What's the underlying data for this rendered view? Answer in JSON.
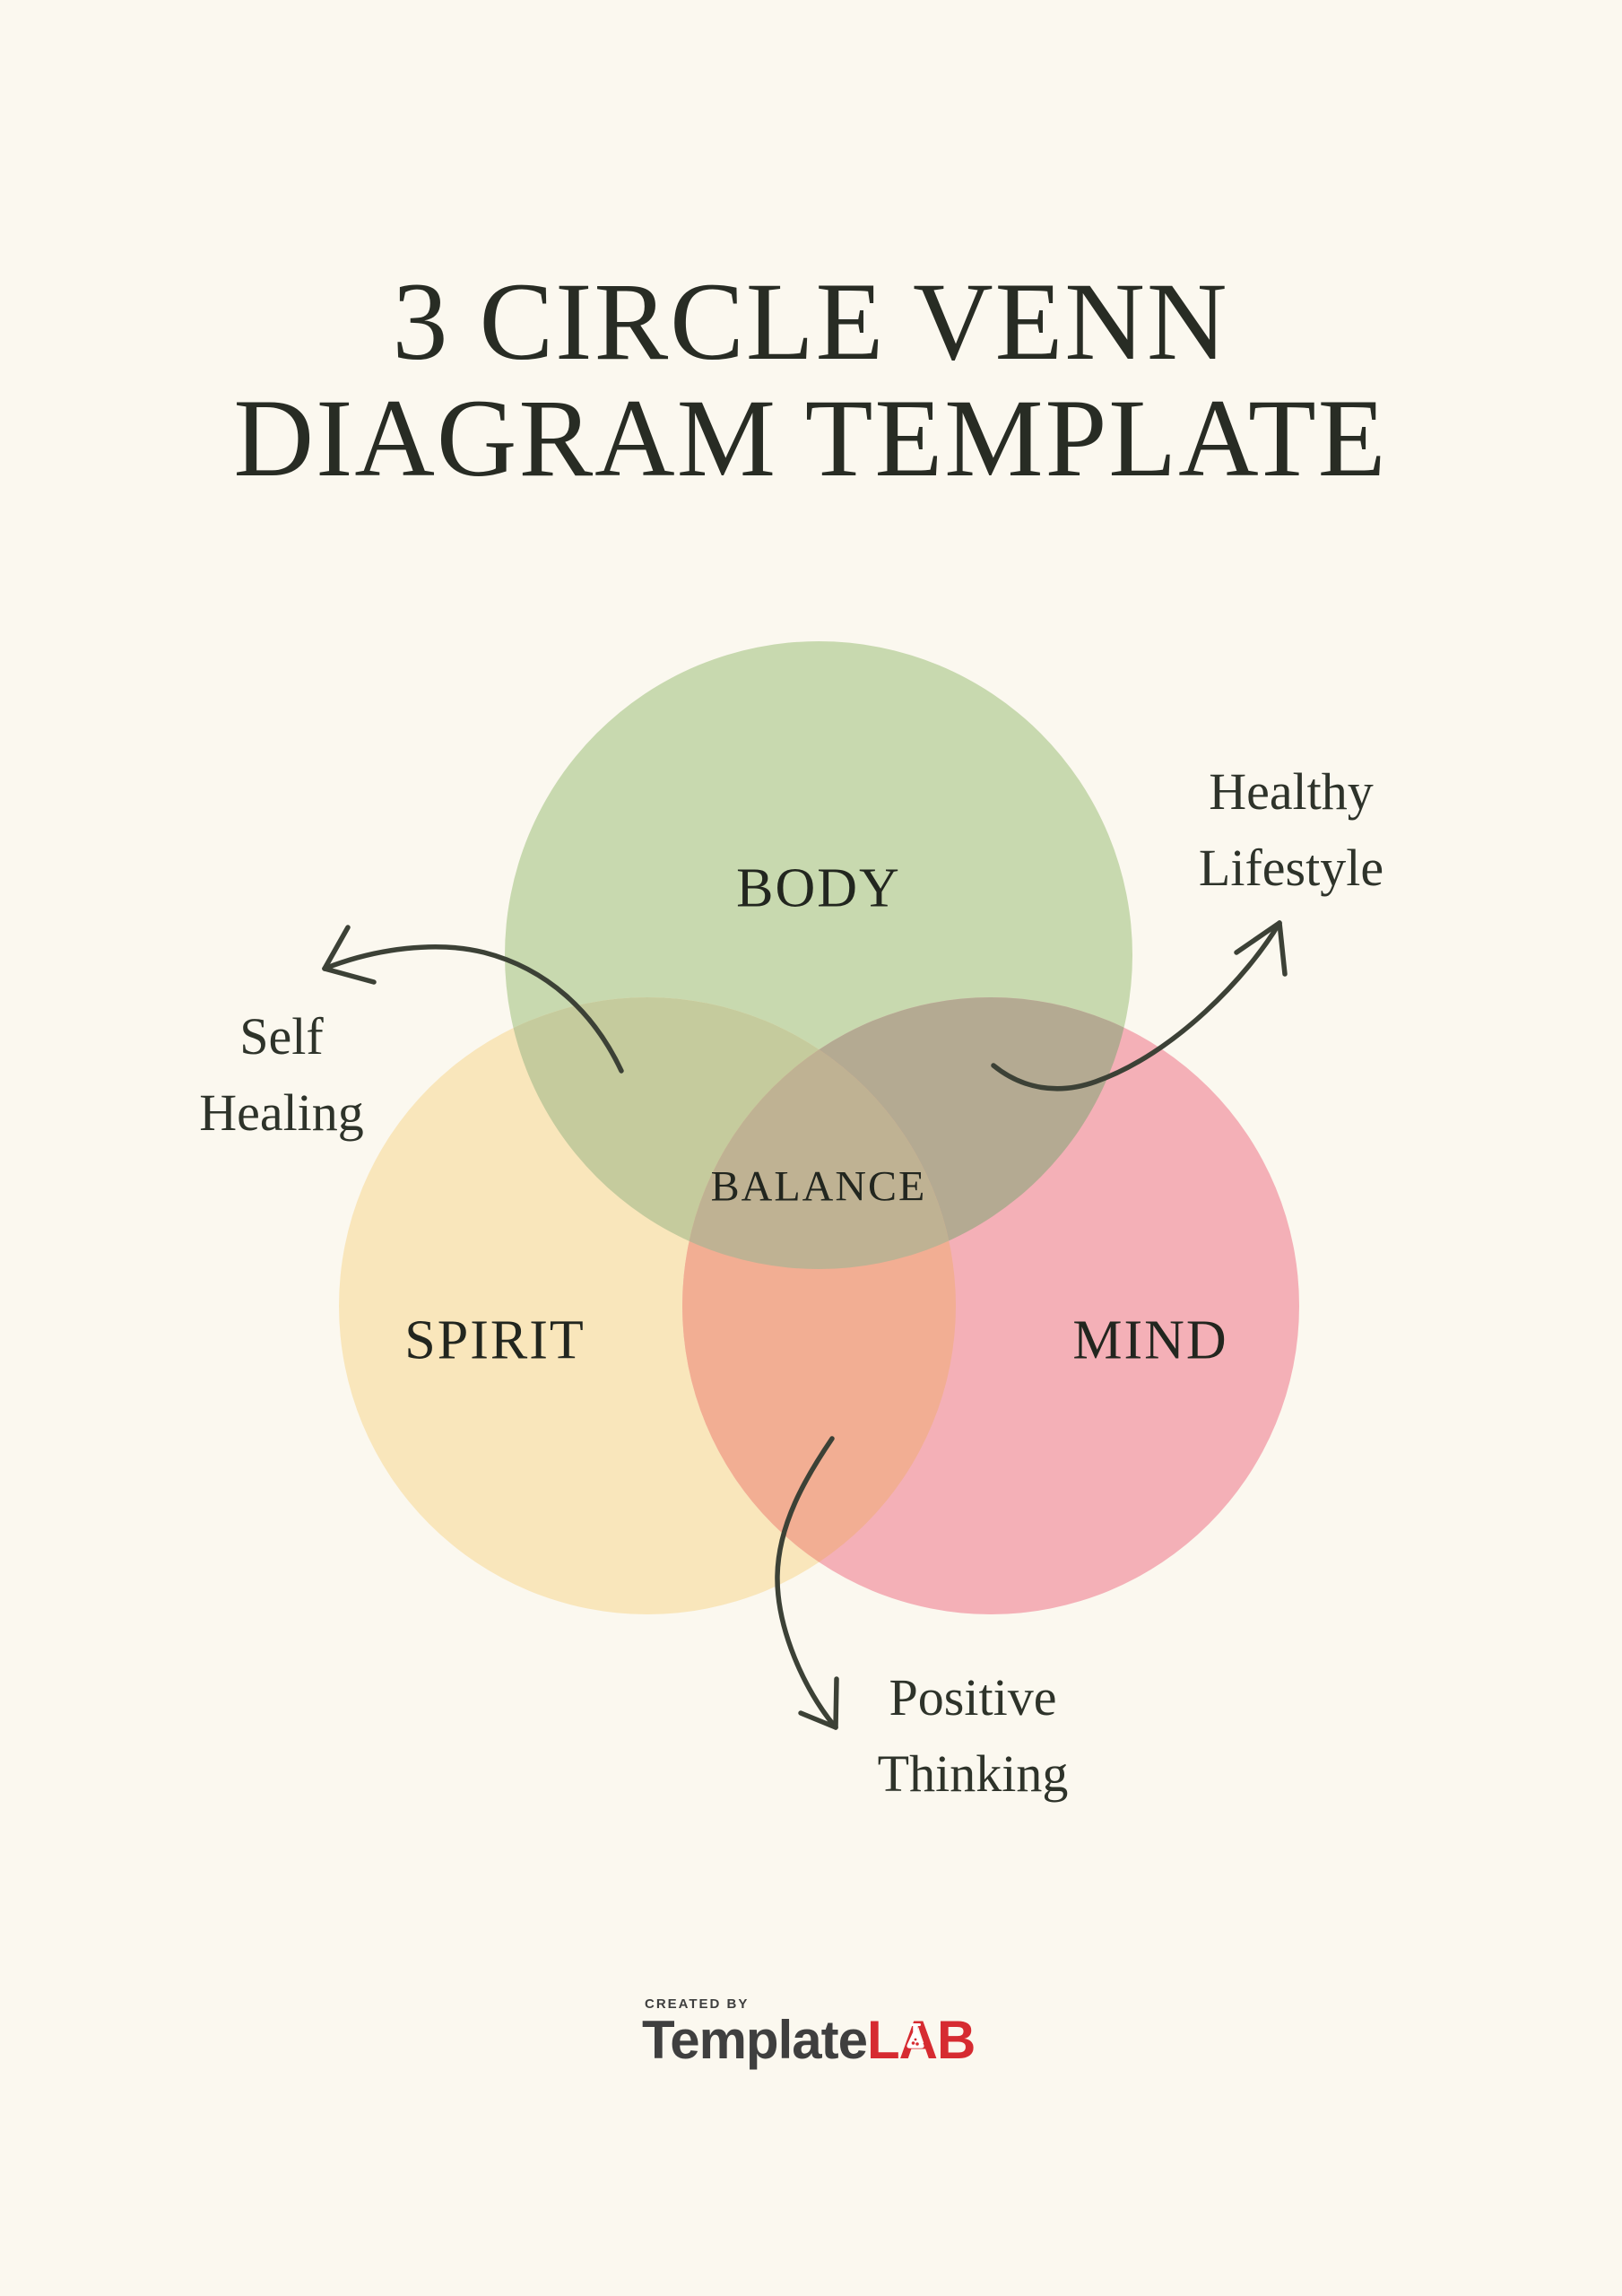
{
  "title": {
    "line1": "3 CIRCLE VENN",
    "line2": "DIAGRAM TEMPLATE"
  },
  "diagram": {
    "circles": [
      {
        "id": "body",
        "label": "BODY",
        "color": "#c8d9af"
      },
      {
        "id": "spirit",
        "label": "SPIRIT",
        "color": "#f9e6bb"
      },
      {
        "id": "mind",
        "label": "MIND",
        "color": "#f4b0b7"
      }
    ],
    "center_label": "BALANCE",
    "overlaps": {
      "body_spirit": "#c5cb9d",
      "body_mind": "#b4aa92",
      "spirit_mind": "#f2ae93",
      "center": "#bfb293"
    },
    "annotations": [
      {
        "id": "self-healing",
        "line1": "Self",
        "line2": "Healing",
        "points_to": "body-spirit overlap"
      },
      {
        "id": "healthy-lifestyle",
        "line1": "Healthy",
        "line2": "Lifestyle",
        "points_to": "body-mind overlap"
      },
      {
        "id": "positive-thinking",
        "line1": "Positive",
        "line2": "Thinking",
        "points_to": "spirit-mind overlap"
      }
    ],
    "arrow_color": "#3c4136"
  },
  "footer": {
    "created_by": "CREATED BY",
    "brand_part1": "Template",
    "brand_part2": "LAB"
  },
  "colors": {
    "background": "#fbf8ef",
    "title_text": "#282c24",
    "label_text": "#22261f",
    "annotation_text": "#2e332a",
    "arrow": "#3c4136",
    "brand_dark": "#3f3f3f",
    "brand_red": "#d62b31"
  }
}
